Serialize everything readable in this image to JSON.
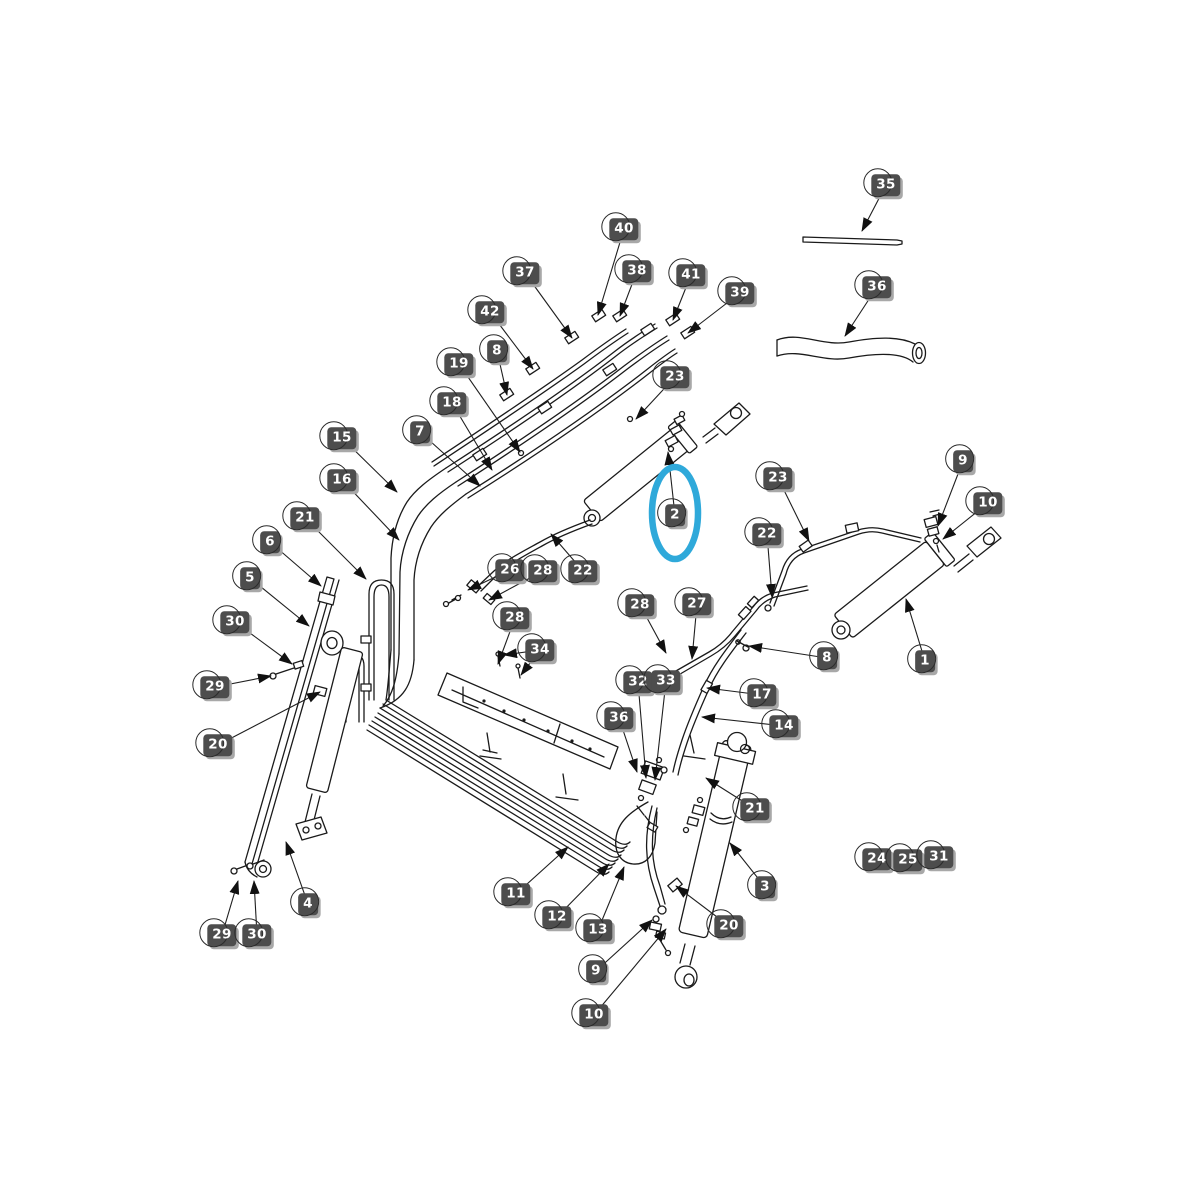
{
  "figure": {
    "type": "exploded-parts-diagram",
    "background": "#ffffff",
    "line_color": "#1a1a1a",
    "badge_bg": "#4d4d4d",
    "badge_text_color": "#ffffff",
    "badge_shadow": "#a8a8a8"
  },
  "highlight": {
    "part_label": "2",
    "color": "#2fa9da",
    "cx": 675,
    "cy": 513,
    "rx": 23,
    "ry": 46,
    "stroke_width": 6.5
  },
  "callouts": [
    {
      "label": "35",
      "x": 886,
      "y": 185,
      "tips": [
        [
          862,
          231
        ]
      ]
    },
    {
      "label": "36",
      "x": 877,
      "y": 287,
      "tips": [
        [
          845,
          336
        ]
      ]
    },
    {
      "label": "40",
      "x": 624,
      "y": 229,
      "tips": [
        [
          598,
          315
        ]
      ]
    },
    {
      "label": "37",
      "x": 525,
      "y": 273,
      "tips": [
        [
          572,
          338
        ]
      ]
    },
    {
      "label": "38",
      "x": 637,
      "y": 271,
      "tips": [
        [
          620,
          316
        ]
      ]
    },
    {
      "label": "41",
      "x": 691,
      "y": 275,
      "tips": [
        [
          673,
          320
        ]
      ]
    },
    {
      "label": "39",
      "x": 740,
      "y": 293,
      "tips": [
        [
          688,
          333
        ]
      ]
    },
    {
      "label": "42",
      "x": 490,
      "y": 312,
      "tips": [
        [
          533,
          369
        ]
      ]
    },
    {
      "label": "8",
      "x": 497,
      "y": 351,
      "tips": [
        [
          507,
          395
        ]
      ]
    },
    {
      "label": "19",
      "x": 459,
      "y": 364,
      "tips": [
        [
          520,
          452
        ]
      ]
    },
    {
      "label": "18",
      "x": 452,
      "y": 403,
      "tips": [
        [
          492,
          470
        ]
      ]
    },
    {
      "label": "23",
      "x": 675,
      "y": 377,
      "tips": [
        [
          636,
          419
        ]
      ]
    },
    {
      "label": "7",
      "x": 420,
      "y": 432,
      "tips": [
        [
          480,
          486
        ]
      ]
    },
    {
      "label": "15",
      "x": 342,
      "y": 438,
      "tips": [
        [
          397,
          492
        ]
      ]
    },
    {
      "label": "16",
      "x": 342,
      "y": 480,
      "tips": [
        [
          399,
          540
        ]
      ]
    },
    {
      "label": "21",
      "x": 305,
      "y": 518,
      "tips": [
        [
          366,
          579
        ]
      ]
    },
    {
      "label": "6",
      "x": 270,
      "y": 542,
      "tips": [
        [
          321,
          586
        ]
      ]
    },
    {
      "label": "5",
      "x": 250,
      "y": 578,
      "tips": [
        [
          309,
          626
        ]
      ]
    },
    {
      "label": "30",
      "x": 235,
      "y": 622,
      "tips": [
        [
          292,
          664
        ]
      ]
    },
    {
      "label": "29",
      "x": 215,
      "y": 687,
      "tips": [
        [
          271,
          676
        ]
      ]
    },
    {
      "label": "20",
      "x": 218,
      "y": 745,
      "tips": [
        [
          320,
          692
        ]
      ]
    },
    {
      "label": "26",
      "x": 510,
      "y": 570,
      "tips": [
        [
          468,
          590
        ]
      ]
    },
    {
      "label": "28",
      "x": 543,
      "y": 571,
      "tips": [
        [
          489,
          600
        ]
      ]
    },
    {
      "label": "22",
      "x": 583,
      "y": 571,
      "tips": [
        [
          551,
          534
        ]
      ]
    },
    {
      "label": "28",
      "x": 515,
      "y": 618,
      "tips": [
        [
          498,
          664
        ]
      ]
    },
    {
      "label": "34",
      "x": 540,
      "y": 650,
      "tips": [
        [
          504,
          655
        ],
        [
          521,
          675
        ]
      ]
    },
    {
      "label": "2",
      "x": 675,
      "y": 515,
      "tips": [
        [
          668,
          452
        ]
      ]
    },
    {
      "label": "23",
      "x": 778,
      "y": 478,
      "tips": [
        [
          809,
          541
        ]
      ]
    },
    {
      "label": "22",
      "x": 767,
      "y": 534,
      "tips": [
        [
          772,
          597
        ]
      ]
    },
    {
      "label": "9",
      "x": 963,
      "y": 461,
      "tips": [
        [
          938,
          526
        ]
      ]
    },
    {
      "label": "10",
      "x": 988,
      "y": 503,
      "tips": [
        [
          943,
          539
        ]
      ]
    },
    {
      "label": "1",
      "x": 925,
      "y": 661,
      "tips": [
        [
          906,
          599
        ]
      ]
    },
    {
      "label": "8",
      "x": 827,
      "y": 658,
      "tips": [
        [
          749,
          646
        ]
      ]
    },
    {
      "label": "28",
      "x": 640,
      "y": 605,
      "tips": [
        [
          666,
          653
        ]
      ]
    },
    {
      "label": "27",
      "x": 697,
      "y": 604,
      "tips": [
        [
          692,
          659
        ]
      ]
    },
    {
      "label": "32",
      "x": 638,
      "y": 682,
      "tips": [
        [
          646,
          778
        ]
      ]
    },
    {
      "label": "33",
      "x": 666,
      "y": 681,
      "tips": [
        [
          655,
          780
        ]
      ]
    },
    {
      "label": "36",
      "x": 619,
      "y": 718,
      "tips": [
        [
          637,
          772
        ]
      ]
    },
    {
      "label": "17",
      "x": 762,
      "y": 695,
      "tips": [
        [
          707,
          688
        ]
      ]
    },
    {
      "label": "14",
      "x": 784,
      "y": 726,
      "tips": [
        [
          702,
          717
        ]
      ]
    },
    {
      "label": "21",
      "x": 755,
      "y": 809,
      "tips": [
        [
          706,
          778
        ]
      ]
    },
    {
      "label": "3",
      "x": 765,
      "y": 887,
      "tips": [
        [
          730,
          843
        ]
      ]
    },
    {
      "label": "20",
      "x": 729,
      "y": 926,
      "tips": [
        [
          676,
          886
        ]
      ]
    },
    {
      "label": "9",
      "x": 596,
      "y": 971,
      "tips": [
        [
          652,
          920
        ]
      ]
    },
    {
      "label": "10",
      "x": 594,
      "y": 1015,
      "tips": [
        [
          666,
          929
        ]
      ]
    },
    {
      "label": "11",
      "x": 516,
      "y": 894,
      "tips": [
        [
          568,
          847
        ]
      ]
    },
    {
      "label": "12",
      "x": 557,
      "y": 917,
      "tips": [
        [
          609,
          864
        ]
      ]
    },
    {
      "label": "13",
      "x": 598,
      "y": 930,
      "tips": [
        [
          624,
          867
        ]
      ]
    },
    {
      "label": "4",
      "x": 308,
      "y": 904,
      "tips": [
        [
          286,
          842
        ]
      ]
    },
    {
      "label": "29",
      "x": 222,
      "y": 935,
      "tips": [
        [
          238,
          881
        ]
      ]
    },
    {
      "label": "30",
      "x": 257,
      "y": 935,
      "tips": [
        [
          254,
          881
        ]
      ]
    },
    {
      "label": "24",
      "x": 877,
      "y": 859,
      "tips": []
    },
    {
      "label": "25",
      "x": 908,
      "y": 860,
      "tips": []
    },
    {
      "label": "31",
      "x": 939,
      "y": 857,
      "tips": []
    }
  ]
}
